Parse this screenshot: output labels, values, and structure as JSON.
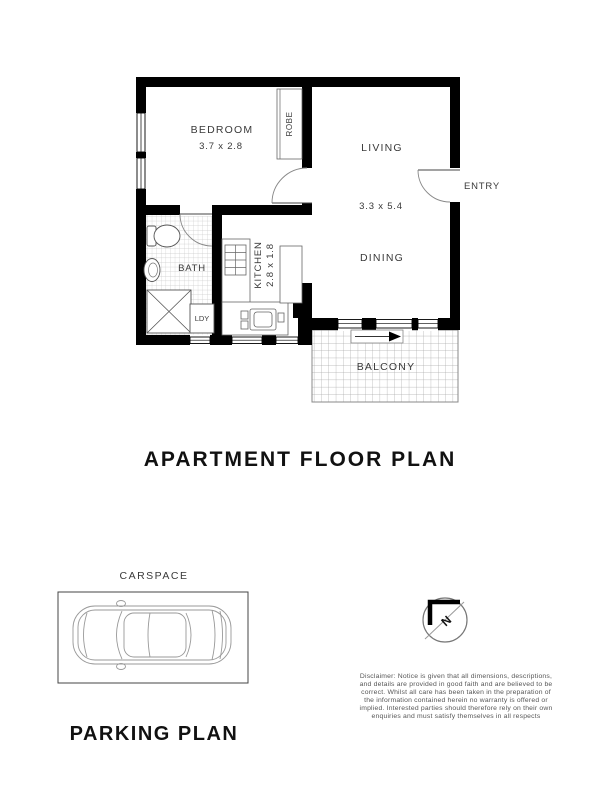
{
  "floor_plan": {
    "title": "APARTMENT FLOOR PLAN",
    "rooms": {
      "bedroom": {
        "label": "BEDROOM",
        "dimensions": "3.7 x 2.8"
      },
      "robe": {
        "label": "ROBE"
      },
      "living": {
        "label": "LIVING"
      },
      "dining": {
        "label": "DINING"
      },
      "entry": {
        "label": "ENTRY"
      },
      "bath": {
        "label": "BATH"
      },
      "kitchen": {
        "label": "KITCHEN",
        "dimensions": "2.8 x 1.8"
      },
      "laundry": {
        "label": "LDY"
      },
      "balcony": {
        "label": "BALCONY"
      }
    },
    "living_dining_dimensions": "3.3 x 5.4"
  },
  "parking_plan": {
    "title": "PARKING PLAN",
    "carspace_label": "CARSPACE"
  },
  "compass": {
    "north_label": "N"
  },
  "disclaimer": {
    "lines": [
      "Disclaimer: Notice is given that all dimensions, descriptions,",
      "and details are provided in good faith and are believed to be",
      "correct. Whilst all care has been taken in the preparation of",
      "the information contained herein no warranty is offered or",
      "implied. Interested parties should therefore rely on their own",
      "enquiries and must satisfy themselves in all respects"
    ]
  },
  "colors": {
    "wall": "#000000",
    "background": "#ffffff",
    "label_text": "#3a3a3a",
    "title_text": "#111111",
    "disclaimer_text": "#565656",
    "drawing_line": "#999999",
    "tile_line": "#c8c8c8"
  }
}
